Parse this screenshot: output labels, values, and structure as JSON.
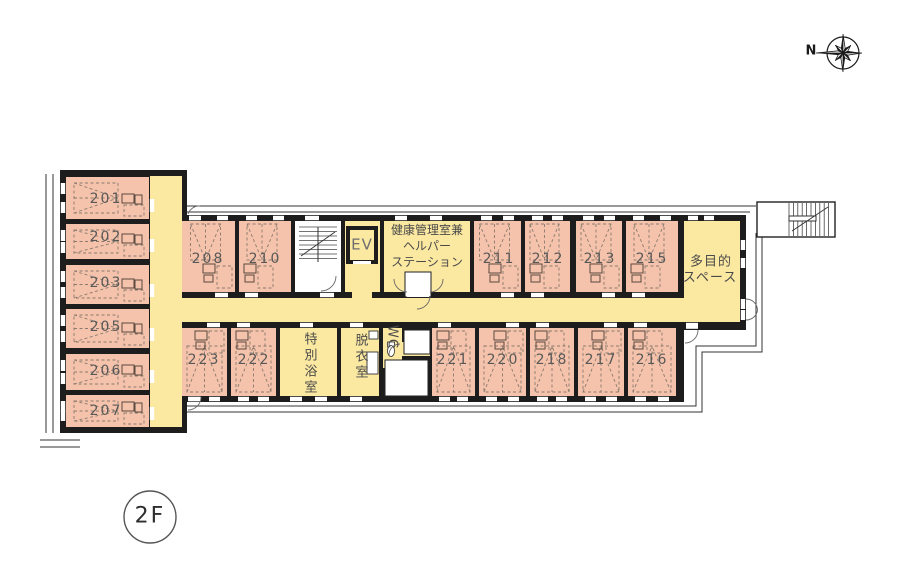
{
  "floor": {
    "badge": "2F"
  },
  "compass": {
    "north_label": "N"
  },
  "rooms": {
    "r201": "201",
    "r202": "202",
    "r203": "203",
    "r205": "205",
    "r206": "206",
    "r207": "207",
    "r208": "208",
    "r210": "210",
    "r211": "211",
    "r212": "212",
    "r213": "213",
    "r215": "215",
    "r216": "216",
    "r217": "217",
    "r218": "218",
    "r220": "220",
    "r221": "221",
    "r222": "222",
    "r223": "223"
  },
  "facilities": {
    "elevator": "EV",
    "health_station_lines": [
      "健康管理室兼",
      "ヘルパー",
      "ステーション"
    ],
    "multipurpose_lines": [
      "多目的",
      "スペース"
    ],
    "special_bathroom": "特別浴室",
    "dressing_room": "脱衣室",
    "toilet": "WC"
  },
  "colors": {
    "resident_room": "#F5C3AB",
    "common_area": "#FBE8A1",
    "wall": "#1D1D1D",
    "outline": "#333333"
  }
}
